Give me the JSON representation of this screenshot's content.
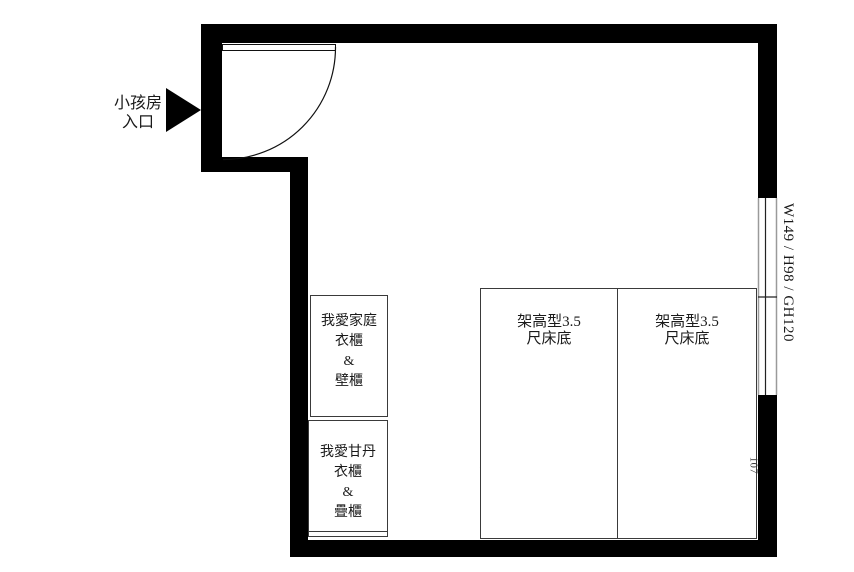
{
  "entrance": {
    "label_line1": "小孩房",
    "label_line2": "入口",
    "arrow_icon": "right-filled-triangle"
  },
  "window": {
    "annotation": "W149 / H98 / GH120"
  },
  "dimensions": {
    "bed_offset": "107"
  },
  "cabinets": [
    {
      "lines": [
        "我愛家庭",
        "衣櫃",
        "&",
        "壁櫃"
      ]
    },
    {
      "lines": [
        "我愛甘丹",
        "衣櫃",
        "&",
        "疊櫃"
      ]
    }
  ],
  "beds": [
    {
      "label_line1": "架高型3.5",
      "label_line2": "尺床底"
    },
    {
      "label_line1": "架高型3.5",
      "label_line2": "尺床底"
    }
  ],
  "colors": {
    "wall": "#000000",
    "line": "#3a3a3a",
    "background": "#ffffff"
  }
}
